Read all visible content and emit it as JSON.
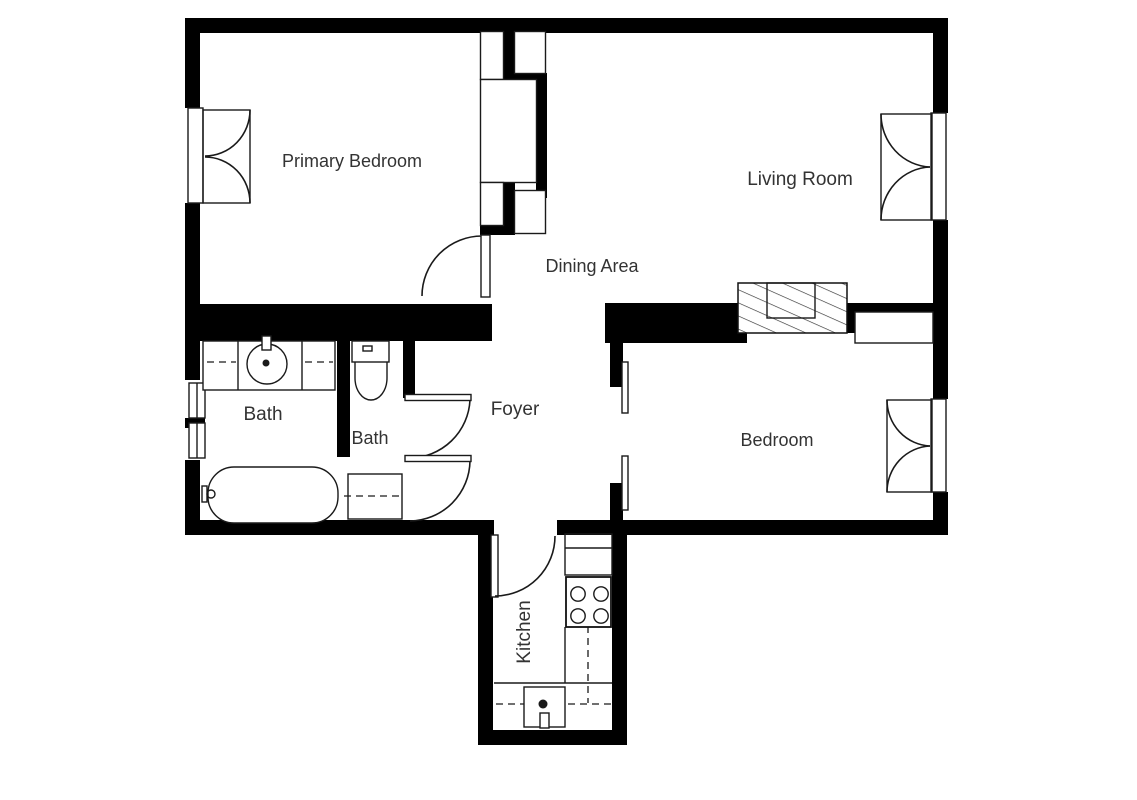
{
  "plan": {
    "type": "apartment-floor-plan",
    "colors": {
      "wall": "#000000",
      "line": "#1a1a1a",
      "text": "#333333",
      "bg": "#ffffff",
      "hatch": "#333333"
    },
    "rooms": [
      {
        "id": "primary-bedroom",
        "label": "Primary Bedroom"
      },
      {
        "id": "living-room",
        "label": "Living Room"
      },
      {
        "id": "dining-area",
        "label": "Dining Area"
      },
      {
        "id": "foyer",
        "label": "Foyer"
      },
      {
        "id": "bath-main",
        "label": "Bath"
      },
      {
        "id": "bath-second",
        "label": "Bath"
      },
      {
        "id": "bedroom",
        "label": "Bedroom"
      },
      {
        "id": "kitchen",
        "label": "Kitchen"
      }
    ],
    "fixtures": [
      "vanity-counter",
      "round-basin-sink",
      "basin-faucet",
      "bathtub",
      "tub-faucet",
      "toilet",
      "shower-stall",
      "stove-4-burner",
      "kitchen-upper-cabinets",
      "kitchen-counter",
      "kitchen-sink",
      "sink-faucet",
      "hall-closet-built-in",
      "hatched-storage-unit",
      "bedroom-wall-closet"
    ],
    "windows": [
      {
        "room": "Primary Bedroom",
        "wall": "left",
        "type": "french-casement"
      },
      {
        "room": "Bath",
        "wall": "left",
        "type": "fixed-double"
      },
      {
        "room": "Living Room",
        "wall": "right",
        "type": "french-casement"
      },
      {
        "room": "Bedroom",
        "wall": "right",
        "type": "french-casement"
      }
    ],
    "doors": [
      {
        "from": "Dining Area",
        "to": "Primary Bedroom",
        "type": "swing"
      },
      {
        "from": "Foyer",
        "to": "Bath (second)",
        "type": "swing"
      },
      {
        "from": "Foyer",
        "to": "Bath (main)",
        "type": "swing"
      },
      {
        "from": "Foyer",
        "to": "Kitchen",
        "type": "swing"
      },
      {
        "from": "Foyer",
        "to": "Bedroom",
        "type": "sliding-bypass"
      }
    ]
  }
}
